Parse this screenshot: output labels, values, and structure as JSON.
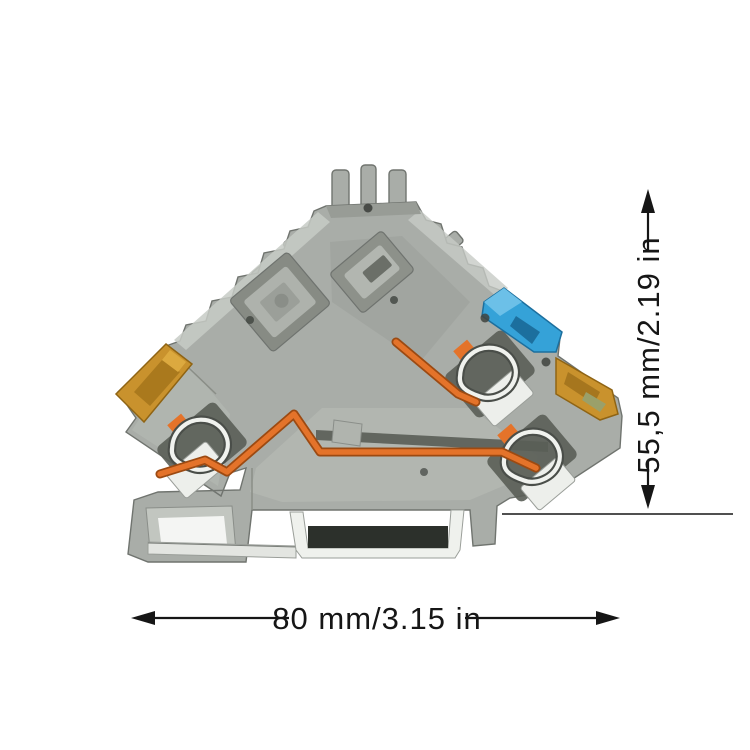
{
  "annotations": {
    "width": "80 mm/3.15 in",
    "height": "55,5 mm/2.19 in"
  },
  "product": {
    "kind": "din-rail-terminal-block-photo",
    "parts": [
      "din-rail",
      "gray-housing",
      "top-mounting-tabs",
      "left-spring-clamp",
      "middle-spring-clamp",
      "right-spring-clamp",
      "orange-conductor",
      "blue-lever",
      "left-amber-terminal-cap",
      "right-amber-terminal-cap"
    ],
    "colors": {
      "housing_gray": "#a9ada8",
      "housing_light": "#c7cbc5",
      "housing_dark": "#8d918a",
      "recess_dark": "#5a5e57",
      "rail_slot_dark": "#2c302b",
      "metal_silver": "#edefeb",
      "conductor_orange": "#e4732a",
      "lever_blue": "#35a2d8",
      "cap_amber": "#c9922d",
      "annotation_black": "#161616",
      "background_white": "#ffffff"
    }
  }
}
